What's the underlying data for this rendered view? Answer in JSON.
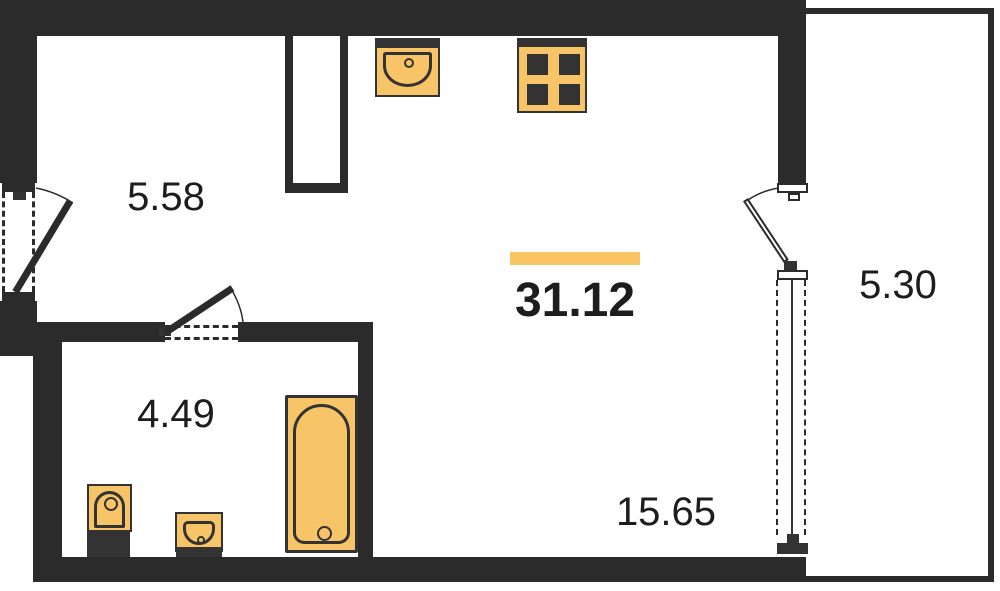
{
  "floor_plan": {
    "total_area": "31.12",
    "rooms": {
      "hall": {
        "area": "5.58"
      },
      "bathroom": {
        "area": "4.49"
      },
      "living_kitchen": {
        "area": "15.65"
      },
      "balcony": {
        "area": "5.30"
      }
    },
    "fixtures": {
      "kitchen_sink": "kitchen-sink",
      "stove": "stove-4-burner",
      "toilet": "toilet",
      "bathroom_sink": "bathroom-sink",
      "bathtub": "bathtub"
    },
    "colors": {
      "wall": "#2b2b2b",
      "fixture": "#f8c468",
      "fixture_dark": "#333333",
      "highlight": "#f9c464",
      "text": "#1d1d1d",
      "background": "#ffffff"
    }
  }
}
